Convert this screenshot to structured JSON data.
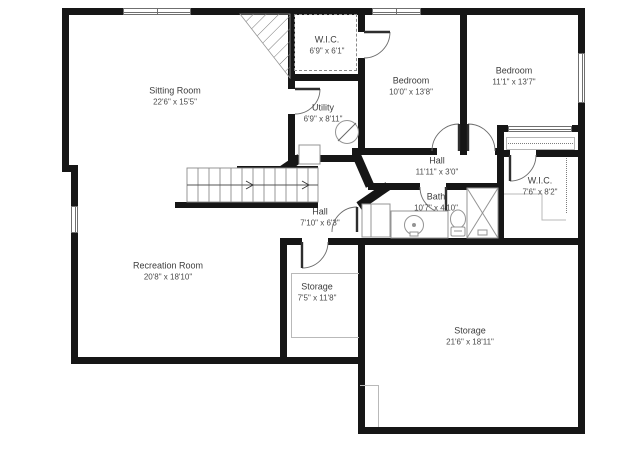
{
  "plan": {
    "title": "Basement floor plan",
    "rooms": [
      {
        "id": "sitting-room",
        "name": "Sitting Room",
        "dims": "22'6\" x 15'5\""
      },
      {
        "id": "wic-top",
        "name": "W.I.C.",
        "dims": "6'9\" x 6'1\""
      },
      {
        "id": "utility",
        "name": "Utility",
        "dims": "6'9\" x 8'11\""
      },
      {
        "id": "bedroom-left",
        "name": "Bedroom",
        "dims": "10'0\" x 13'8\""
      },
      {
        "id": "bedroom-right",
        "name": "Bedroom",
        "dims": "11'1\" x 13'7\""
      },
      {
        "id": "hall-upper",
        "name": "Hall",
        "dims": "11'11\" x 3'0\""
      },
      {
        "id": "wic-right",
        "name": "W.I.C.",
        "dims": "7'6\" x 8'2\""
      },
      {
        "id": "bath",
        "name": "Bath",
        "dims": "10'7\" x 4'10\""
      },
      {
        "id": "hall-lower",
        "name": "Hall",
        "dims": "7'10\" x 6'3\""
      },
      {
        "id": "recreation-room",
        "name": "Recreation Room",
        "dims": "20'8\" x 18'10\""
      },
      {
        "id": "storage-small",
        "name": "Storage",
        "dims": "7'5\" x 11'8\""
      },
      {
        "id": "storage-large",
        "name": "Storage",
        "dims": "21'6\" x 18'11\""
      }
    ],
    "fixtures": [
      "stairs",
      "water-heater",
      "furnace",
      "vanity-sink",
      "toilet",
      "shower",
      "bath-cabinet",
      "closet-rod",
      "sliding-closet-door"
    ],
    "colors": {
      "wall": "#161616",
      "fixture_outline": "#999999",
      "label_text": "#3d3d3d",
      "background": "#ffffff"
    }
  }
}
